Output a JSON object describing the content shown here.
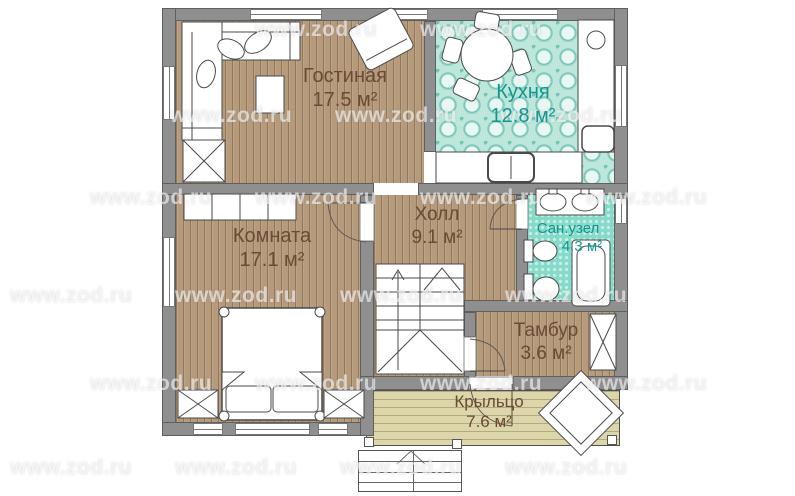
{
  "watermark": {
    "text": "www.zod.ru"
  },
  "rooms": [
    {
      "id": "living",
      "name": "Гостиная",
      "area": "17.5 м²"
    },
    {
      "id": "kitchen",
      "name": "Кухня",
      "area": "12.8 м²"
    },
    {
      "id": "bedroom",
      "name": "Комната",
      "area": "17.1 м²"
    },
    {
      "id": "hall",
      "name": "Холл",
      "area": "9.1 м²"
    },
    {
      "id": "bathroom",
      "name": "Сан.узел",
      "area": "4.3 м²"
    },
    {
      "id": "tambur",
      "name": "Тамбур",
      "area": "3.6 м²"
    },
    {
      "id": "porch",
      "name": "Крыльцо",
      "area": "7.6 м²"
    }
  ],
  "colors": {
    "wall": "#8f8f8f",
    "wallEdge": "#5f5f5f",
    "wood": "#b59a7b",
    "porch": "#ddd6ab",
    "kitchen": "#bce7da",
    "bath": "#86dac9",
    "labelBrown": "#6b4a36",
    "labelTeal": "#13968e"
  }
}
